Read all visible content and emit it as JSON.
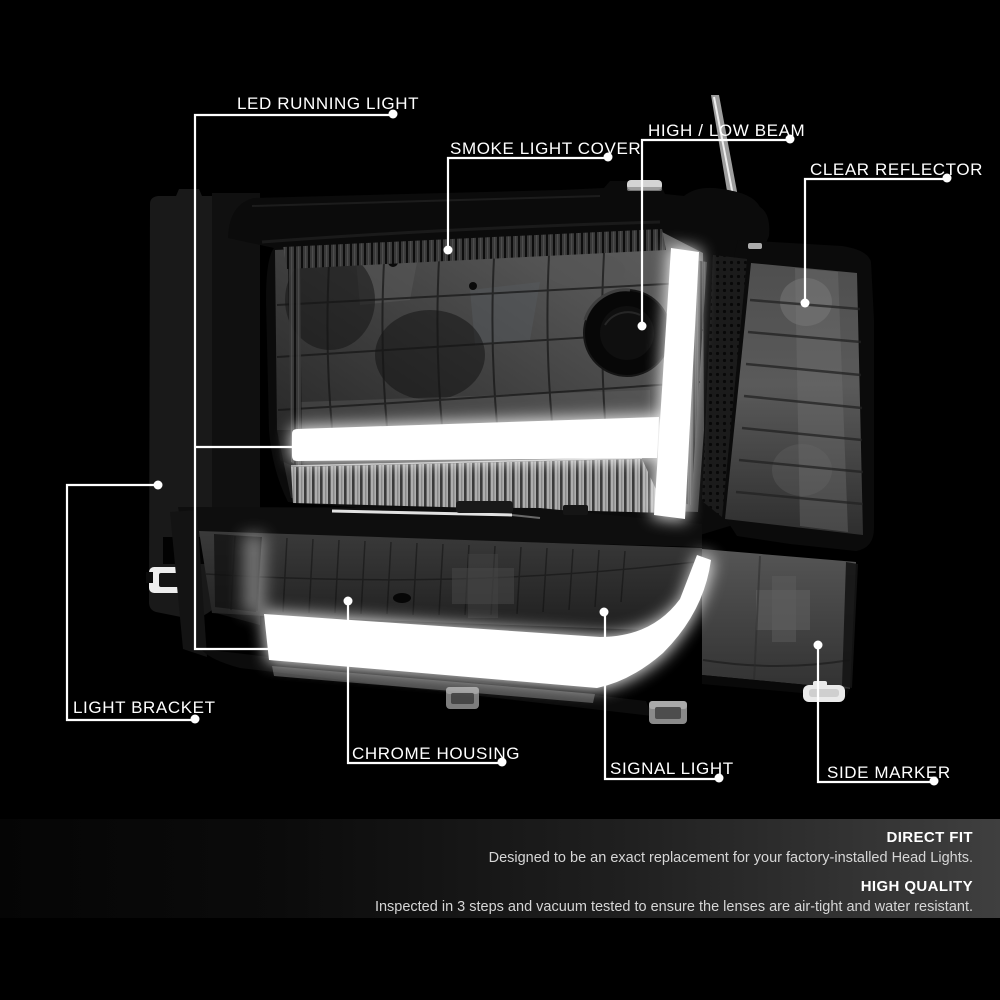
{
  "product": "headlight-assembly-annotated-photo",
  "callouts": [
    {
      "id": "led-running-light",
      "text": "LED RUNNING LIGHT"
    },
    {
      "id": "smoke-light-cover",
      "text": "SMOKE LIGHT COVER"
    },
    {
      "id": "high-low-beam",
      "text": "HIGH / LOW BEAM"
    },
    {
      "id": "clear-reflector",
      "text": "CLEAR REFLECTOR"
    },
    {
      "id": "light-bracket",
      "text": "LIGHT BRACKET"
    },
    {
      "id": "chrome-housing",
      "text": "CHROME HOUSING"
    },
    {
      "id": "signal-light",
      "text": "SIGNAL LIGHT"
    },
    {
      "id": "side-marker",
      "text": "SIDE MARKER"
    }
  ],
  "features": [
    {
      "title": "DIRECT FIT",
      "description": "Designed to be an exact replacement for your factory-installed Head Lights."
    },
    {
      "title": "HIGH QUALITY",
      "description": "Inspected in 3 steps and vacuum tested to ensure the lenses are air-tight and water resistant."
    }
  ],
  "colors": {
    "background": "#000000",
    "annotation_line": "#ffffff",
    "label_text": "#ffffff",
    "feature_band_right": "#3f3f3f",
    "led_glow": "#ffffff"
  }
}
